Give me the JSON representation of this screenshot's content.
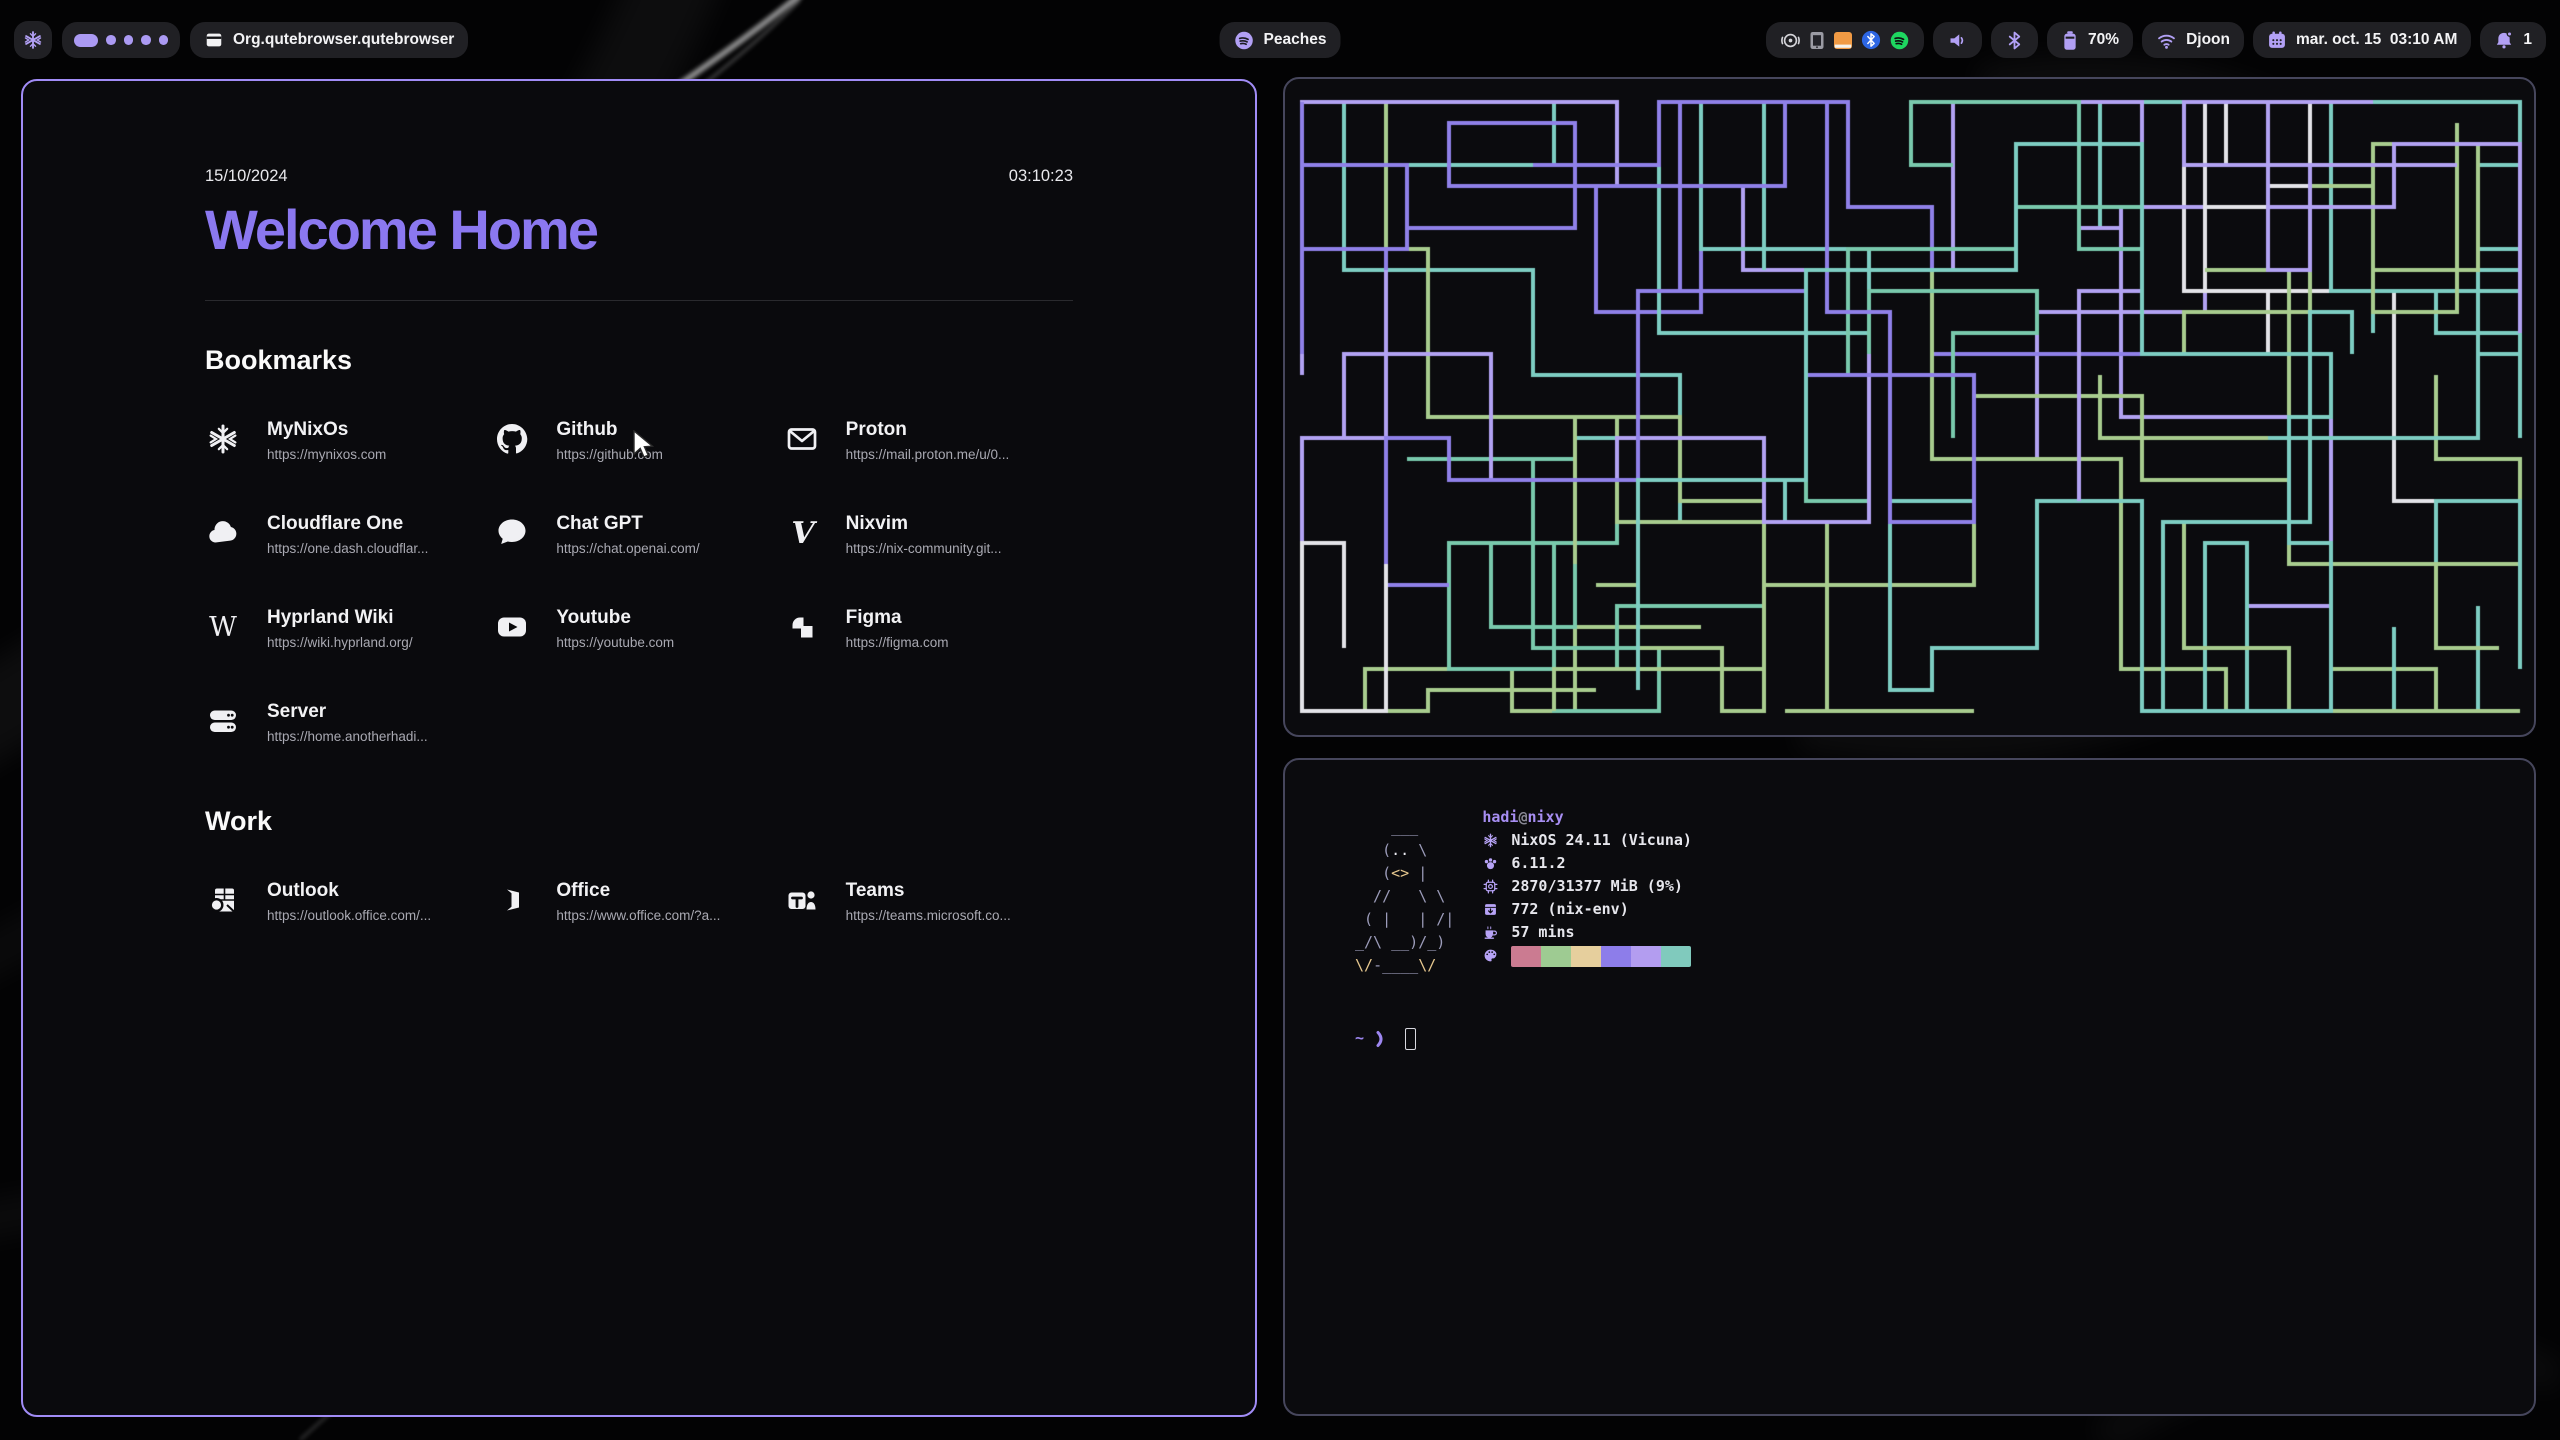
{
  "topbar": {
    "window_title": "Org.qutebrowser.qutebrowser",
    "workspaces": {
      "active_index": 0,
      "total": 5
    },
    "media_label": "Peaches",
    "battery": "70%",
    "wifi": "Djoon",
    "clock": "mar. oct. 15  03:10 AM",
    "notifications": "1"
  },
  "startpage": {
    "date": "15/10/2024",
    "time": "03:10:23",
    "title": "Welcome Home",
    "sections": [
      {
        "heading": "Bookmarks",
        "items": [
          {
            "name": "MyNixOs",
            "url": "https://mynixos.com",
            "icon": "nix"
          },
          {
            "name": "Github",
            "url": "https://github.com",
            "icon": "github"
          },
          {
            "name": "Proton",
            "url": "https://mail.proton.me/u/0...",
            "icon": "mail"
          },
          {
            "name": "Cloudflare One",
            "url": "https://one.dash.cloudflar...",
            "icon": "cloud"
          },
          {
            "name": "Chat GPT",
            "url": "https://chat.openai.com/",
            "icon": "chat"
          },
          {
            "name": "Nixvim",
            "url": "https://nix-community.git...",
            "icon": "nixvim"
          },
          {
            "name": "Hyprland Wiki",
            "url": "https://wiki.hyprland.org/",
            "icon": "wikipedia"
          },
          {
            "name": "Youtube",
            "url": "https://youtube.com",
            "icon": "youtube"
          },
          {
            "name": "Figma",
            "url": "https://figma.com",
            "icon": "figma"
          },
          {
            "name": "Server",
            "url": "https://home.anotherhadi...",
            "icon": "server"
          }
        ]
      },
      {
        "heading": "Work",
        "items": [
          {
            "name": "Outlook",
            "url": "https://outlook.office.com/...",
            "icon": "outlook"
          },
          {
            "name": "Office",
            "url": "https://www.office.com/?a...",
            "icon": "office"
          },
          {
            "name": "Teams",
            "url": "https://teams.microsoft.co...",
            "icon": "teams"
          }
        ]
      }
    ]
  },
  "fetch": {
    "user": "hadi",
    "at": "@",
    "host": "nixy",
    "rows": [
      {
        "icon": "nix",
        "label": "os",
        "text": "NixOS 24.11 (Vicuna)"
      },
      {
        "icon": "kernel",
        "label": "kernel",
        "text": "6.11.2"
      },
      {
        "icon": "memory",
        "label": "memory",
        "text": "2870/31377 MiB (9%)"
      },
      {
        "icon": "packages",
        "label": "packages",
        "text": "772 (nix-env)"
      },
      {
        "icon": "uptime",
        "label": "uptime",
        "text": "57 mins"
      }
    ],
    "palette_icon": "palette",
    "palette": [
      "#cb7b91",
      "#9ecb92",
      "#e6cf9d",
      "#8d7dea",
      "#b39df0",
      "#80cabd"
    ],
    "ascii_colors": {
      "base": "#9c9cba",
      "eye": "#ededf3",
      "beak": "#e7c88f"
    },
    "ascii": [
      [
        {
          "t": "    ___",
          "c": "base"
        }
      ],
      [
        {
          "t": "   (",
          "c": "base"
        },
        {
          "t": "..",
          "c": "eye"
        },
        {
          "t": " \\",
          "c": "base"
        }
      ],
      [
        {
          "t": "   (",
          "c": "base"
        },
        {
          "t": "<>",
          "c": "beak"
        },
        {
          "t": " |",
          "c": "base"
        }
      ],
      [
        {
          "t": "  //   \\ \\",
          "c": "base"
        }
      ],
      [
        {
          "t": " ( |   | /|",
          "c": "base"
        }
      ],
      [
        {
          "t": "_/\\ __)/_)",
          "c": "base"
        }
      ],
      [
        {
          "t": "\\/",
          "c": "beak"
        },
        {
          "t": "-____",
          "c": "base"
        },
        {
          "t": "\\/",
          "c": "beak"
        }
      ]
    ],
    "prompt": {
      "cwd": "~",
      "symbol": "❯"
    }
  },
  "pipes": {
    "seed": 1015,
    "cell": 21,
    "stroke": 4,
    "paths": 30,
    "palette": [
      [
        "#7dcdc2",
        5
      ],
      [
        "#8f80e8",
        3
      ],
      [
        "#b2a2f2",
        2
      ],
      [
        "#e3e3e8",
        3
      ],
      [
        "#a8cc8e",
        2
      ],
      [
        "#e5c693",
        1
      ],
      [
        "#79c9ac",
        1
      ]
    ]
  },
  "colors": {
    "accent": "#ab9af3",
    "focused_border": "#a18cf6",
    "unfocused_border": "#46465c",
    "chip_bg": "#202024",
    "page_title": "#8b78f0",
    "url_text": "#a9a9b2",
    "terminal_purple": "#a78ef2"
  }
}
